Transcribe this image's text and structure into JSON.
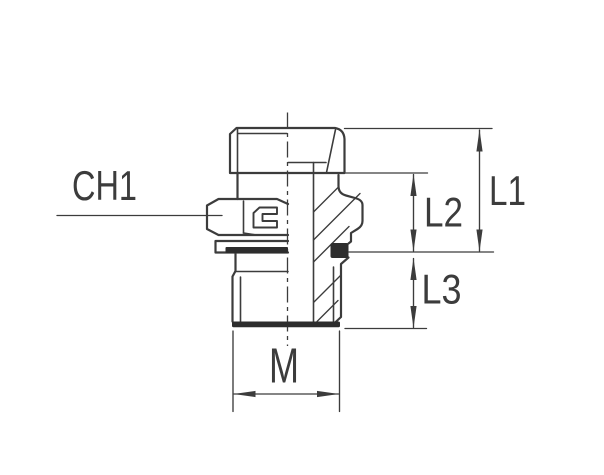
{
  "drawing": {
    "labels": {
      "ch1": "CH1",
      "l1": "L1",
      "l2": "L2",
      "l3": "L3",
      "m": "M"
    },
    "colors": {
      "line": "#3c3c3c",
      "dark_fill": "#2d2d2d",
      "background": "#ffffff"
    }
  }
}
